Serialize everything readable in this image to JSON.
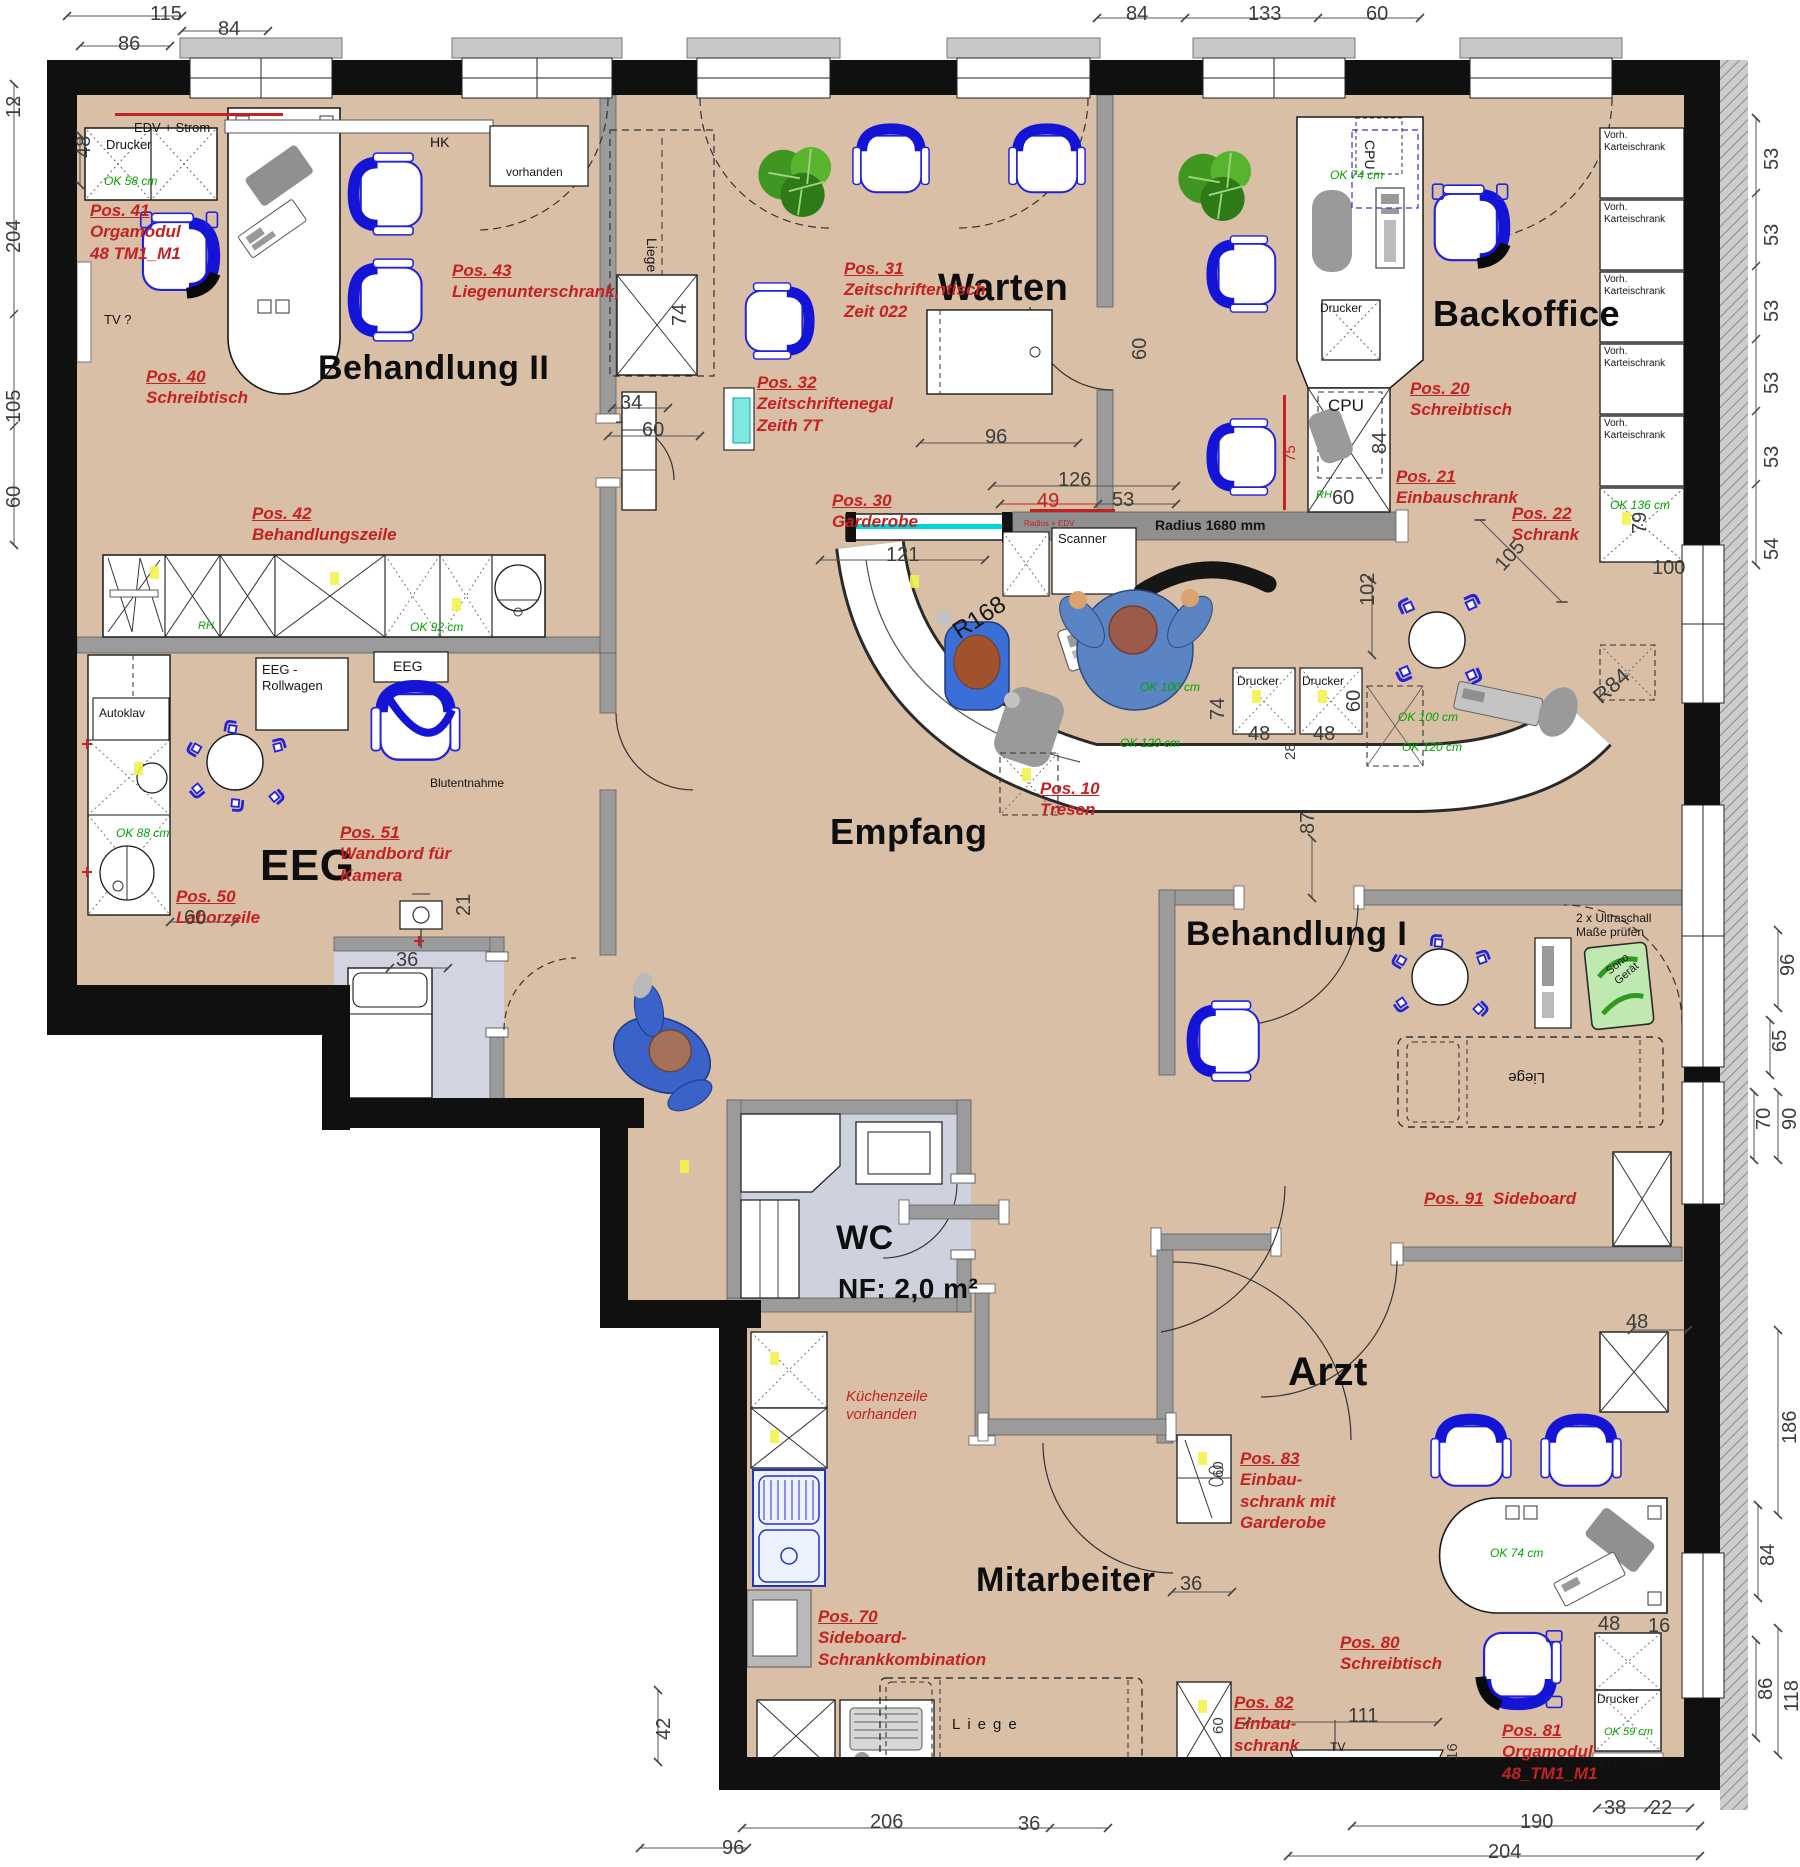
{
  "plan_title": "Praxis Grundriss – Möblierungsplan",
  "colors": {
    "floor": "#d8bfa6",
    "wall": "#101010",
    "inner_wall": "#9b9b9b",
    "pos_red": "#c42222",
    "ok_green": "#00a400",
    "chair_blue": "#1717dd",
    "wet_room": "#ced2de",
    "counter_cyan": "#00d5d5"
  },
  "room_labels": [
    {
      "t": "Behandlung II",
      "x": 318,
      "y": 348,
      "s": 34
    },
    {
      "t": "Warten",
      "x": 938,
      "y": 266,
      "s": 38
    },
    {
      "t": "Backoffice",
      "x": 1433,
      "y": 292,
      "s": 36
    },
    {
      "t": "Empfang",
      "x": 830,
      "y": 810,
      "s": 36
    },
    {
      "t": "EEG",
      "x": 260,
      "y": 840,
      "s": 44
    },
    {
      "t": "Behandlung I",
      "x": 1186,
      "y": 914,
      "s": 34
    },
    {
      "t": "WC",
      "x": 836,
      "y": 1218,
      "s": 34
    },
    {
      "t": "NF: 2,0 m²",
      "x": 838,
      "y": 1272,
      "s": 28
    },
    {
      "t": "Mitarbeiter",
      "x": 976,
      "y": 1560,
      "s": 34
    },
    {
      "t": "Arzt",
      "x": 1288,
      "y": 1348,
      "s": 40
    }
  ],
  "pos_labels": [
    {
      "head": "Pos. 41",
      "rest": [
        "Orgamodul",
        "48 TM1_M1"
      ],
      "x": 90,
      "y": 200
    },
    {
      "head": "Pos. 40",
      "rest": [
        "Schreibtisch"
      ],
      "x": 146,
      "y": 366
    },
    {
      "head": "Pos. 43",
      "rest": [
        "Liegenunterschrank,"
      ],
      "x": 452,
      "y": 260
    },
    {
      "head": "Pos. 42",
      "rest": [
        "Behandlungszeile"
      ],
      "x": 252,
      "y": 503
    },
    {
      "head": "Pos. 31",
      "rest": [
        "Zeitschriftentisch",
        "Zeit 022"
      ],
      "x": 844,
      "y": 258
    },
    {
      "head": "Pos. 32",
      "rest": [
        "Zeitschriftenegal",
        "Zeith 7T"
      ],
      "x": 757,
      "y": 372
    },
    {
      "head": "Pos. 30",
      "rest": [
        "Garderobe"
      ],
      "x": 832,
      "y": 490
    },
    {
      "head": "Pos. 20",
      "rest": [
        "Schreibtisch"
      ],
      "x": 1410,
      "y": 378
    },
    {
      "head": "Pos. 21",
      "rest": [
        "Einbauschrank"
      ],
      "x": 1396,
      "y": 466
    },
    {
      "head": "Pos. 22",
      "rest": [
        "Schrank"
      ],
      "x": 1512,
      "y": 503
    },
    {
      "head": "Pos. 10",
      "rest": [
        "Tresen"
      ],
      "x": 1040,
      "y": 778
    },
    {
      "head": "Pos. 50",
      "rest": [
        "Laborzeile"
      ],
      "x": 176,
      "y": 886
    },
    {
      "head": "Pos. 51",
      "rest": [
        "Wandbord für",
        "Kamera"
      ],
      "x": 340,
      "y": 822
    },
    {
      "head": "Pos. 91",
      "inline": "Sideboard",
      "rest": [],
      "x": 1424,
      "y": 1188
    },
    {
      "head": "Pos. 83",
      "rest": [
        "Einbau-",
        "schrank mit",
        "Garderobe"
      ],
      "x": 1240,
      "y": 1448
    },
    {
      "head": "Pos. 82",
      "rest": [
        "Einbau-",
        "schrank"
      ],
      "x": 1234,
      "y": 1692
    },
    {
      "head": "Pos. 80",
      "rest": [
        "Schreibtisch"
      ],
      "x": 1340,
      "y": 1632
    },
    {
      "head": "Pos. 81",
      "rest": [
        "Orgamodul",
        "48_TM1_M1"
      ],
      "x": 1502,
      "y": 1720
    },
    {
      "head": "Pos. 70",
      "rest": [
        "Sideboard-",
        "Schrankkombination"
      ],
      "x": 818,
      "y": 1606
    }
  ],
  "notes": [
    {
      "lines": [
        "EDV + Strom"
      ],
      "x": 134,
      "y": 120,
      "s": 13
    },
    {
      "lines": [
        "Drucker"
      ],
      "x": 106,
      "y": 137,
      "s": 13
    },
    {
      "lines": [
        "OK 58 cm"
      ],
      "x": 104,
      "y": 174,
      "s": 12,
      "c": "#00a400",
      "i": 1
    },
    {
      "lines": [
        "TV ?"
      ],
      "x": 104,
      "y": 312,
      "s": 13
    },
    {
      "lines": [
        "HK"
      ],
      "x": 430,
      "y": 134,
      "s": 14
    },
    {
      "lines": [
        "vorhanden"
      ],
      "x": 506,
      "y": 165,
      "s": 12
    },
    {
      "lines": [
        "Liege"
      ],
      "x": 660,
      "y": 238,
      "s": 14,
      "rot": 90
    },
    {
      "lines": [
        "Scanner"
      ],
      "x": 1058,
      "y": 531,
      "s": 13
    },
    {
      "lines": [
        "Radius 1680 mm"
      ],
      "x": 1155,
      "y": 517,
      "s": 14,
      "b": 1
    },
    {
      "lines": [
        "Radius + EDV"
      ],
      "x": 1024,
      "y": 519,
      "s": 8,
      "c": "#c42222"
    },
    {
      "lines": [
        "R168"
      ],
      "x": 948,
      "y": 622,
      "s": 24,
      "rot": -33
    },
    {
      "lines": [
        "OK 100 cm"
      ],
      "x": 1140,
      "y": 680,
      "s": 12,
      "c": "#00a400",
      "i": 1
    },
    {
      "lines": [
        "OK 120 cm"
      ],
      "x": 1120,
      "y": 736,
      "s": 12,
      "c": "#00a400",
      "i": 1
    },
    {
      "lines": [
        "OK 100 cm"
      ],
      "x": 1398,
      "y": 710,
      "s": 12,
      "c": "#00a400",
      "i": 1
    },
    {
      "lines": [
        "OK 120 cm"
      ],
      "x": 1402,
      "y": 740,
      "s": 12,
      "c": "#00a400",
      "i": 1
    },
    {
      "lines": [
        "Drucker"
      ],
      "x": 1237,
      "y": 674,
      "s": 12
    },
    {
      "lines": [
        "Drucker"
      ],
      "x": 1302,
      "y": 674,
      "s": 12
    },
    {
      "lines": [
        "OK 74 cm"
      ],
      "x": 1330,
      "y": 168,
      "s": 12,
      "c": "#00a400",
      "i": 1
    },
    {
      "lines": [
        "Drucker"
      ],
      "x": 1320,
      "y": 301,
      "s": 12
    },
    {
      "lines": [
        "CPU"
      ],
      "x": 1328,
      "y": 396,
      "s": 17
    },
    {
      "lines": [
        "CPU"
      ],
      "x": 1378,
      "y": 140,
      "s": 14,
      "rot": 90
    },
    {
      "lines": [
        "Vorh.",
        "Karteischrank"
      ],
      "x": 1604,
      "y": 130,
      "s": 10
    },
    {
      "lines": [
        "Vorh.",
        "Karteischrank"
      ],
      "x": 1604,
      "y": 202,
      "s": 10
    },
    {
      "lines": [
        "Vorh.",
        "Karteischrank"
      ],
      "x": 1604,
      "y": 274,
      "s": 10
    },
    {
      "lines": [
        "Vorh.",
        "Karteischrank"
      ],
      "x": 1604,
      "y": 346,
      "s": 10
    },
    {
      "lines": [
        "Vorh.",
        "Karteischrank"
      ],
      "x": 1604,
      "y": 418,
      "s": 10
    },
    {
      "lines": [
        "OK 136 cm"
      ],
      "x": 1610,
      "y": 498,
      "s": 12,
      "c": "#00a400",
      "i": 1
    },
    {
      "lines": [
        "EEG -",
        "Rollwagen"
      ],
      "x": 262,
      "y": 662,
      "s": 13
    },
    {
      "lines": [
        "EEG"
      ],
      "x": 393,
      "y": 658,
      "s": 14
    },
    {
      "lines": [
        "Autoklav"
      ],
      "x": 99,
      "y": 706,
      "s": 12
    },
    {
      "lines": [
        "Blutentnahme"
      ],
      "x": 430,
      "y": 776,
      "s": 12
    },
    {
      "lines": [
        "OK 92 cm"
      ],
      "x": 410,
      "y": 620,
      "s": 12,
      "c": "#00a400",
      "i": 1
    },
    {
      "lines": [
        "RH"
      ],
      "x": 198,
      "y": 620,
      "s": 11,
      "c": "#00a400",
      "i": 1
    },
    {
      "lines": [
        "RH"
      ],
      "x": 1316,
      "y": 489,
      "s": 11,
      "c": "#00a400",
      "i": 1
    },
    {
      "lines": [
        "OK 88 cm"
      ],
      "x": 116,
      "y": 826,
      "s": 12,
      "c": "#00a400",
      "i": 1
    },
    {
      "lines": [
        "2 x Ultraschall",
        "Maße prüfen"
      ],
      "x": 1576,
      "y": 911,
      "s": 12
    },
    {
      "lines": [
        "Sono",
        "Gerät"
      ],
      "x": 1604,
      "y": 968,
      "s": 11,
      "rot": -40
    },
    {
      "lines": [
        "Liege"
      ],
      "x": 1545,
      "y": 1086,
      "s": 15,
      "rot": 180
    },
    {
      "lines": [
        "Liege"
      ],
      "x": 952,
      "y": 1716,
      "s": 15,
      "ls": 7
    },
    {
      "lines": [
        "TV"
      ],
      "x": 1330,
      "y": 1740,
      "s": 12
    },
    {
      "lines": [
        "Drucker"
      ],
      "x": 1597,
      "y": 1692,
      "s": 12
    },
    {
      "lines": [
        "OK 59 cm"
      ],
      "x": 1604,
      "y": 1726,
      "s": 11,
      "c": "#00a400",
      "i": 1
    },
    {
      "lines": [
        "EDV + Strom"
      ],
      "x": 1599,
      "y": 1756,
      "s": 12
    },
    {
      "lines": [
        "OK 74 cm"
      ],
      "x": 1490,
      "y": 1546,
      "s": 12,
      "c": "#00a400",
      "i": 1
    },
    {
      "lines": [
        "Küchenzeile",
        "vorhanden"
      ],
      "x": 846,
      "y": 1388,
      "s": 15,
      "c": "#c42222",
      "i": 1
    }
  ],
  "dims": [
    {
      "t": "115",
      "x": 150,
      "y": 2
    },
    {
      "t": "86",
      "x": 118,
      "y": 32
    },
    {
      "t": "84",
      "x": 218,
      "y": 17
    },
    {
      "t": "84",
      "x": 1126,
      "y": 2
    },
    {
      "t": "133",
      "x": 1248,
      "y": 2
    },
    {
      "t": "60",
      "x": 1366,
      "y": 2
    },
    {
      "t": "12",
      "x": 2,
      "y": 118,
      "rot": -90
    },
    {
      "t": "204",
      "x": 2,
      "y": 253,
      "rot": -90
    },
    {
      "t": "105",
      "x": 2,
      "y": 423,
      "rot": -90
    },
    {
      "t": "60",
      "x": 2,
      "y": 508,
      "rot": -90
    },
    {
      "t": "48",
      "x": 72,
      "y": 158,
      "rot": -90
    },
    {
      "t": "53",
      "x": 1760,
      "y": 170,
      "rot": -90
    },
    {
      "t": "53",
      "x": 1760,
      "y": 246,
      "rot": -90
    },
    {
      "t": "53",
      "x": 1760,
      "y": 322,
      "rot": -90
    },
    {
      "t": "53",
      "x": 1760,
      "y": 394,
      "rot": -90
    },
    {
      "t": "53",
      "x": 1760,
      "y": 468,
      "rot": -90
    },
    {
      "t": "54",
      "x": 1760,
      "y": 560,
      "rot": -90
    },
    {
      "t": "79",
      "x": 1628,
      "y": 534,
      "rot": -90
    },
    {
      "t": "100",
      "x": 1652,
      "y": 556
    },
    {
      "t": "96",
      "x": 1776,
      "y": 976,
      "rot": -90
    },
    {
      "t": "65",
      "x": 1768,
      "y": 1052,
      "rot": -90
    },
    {
      "t": "90",
      "x": 1778,
      "y": 1130,
      "rot": -90
    },
    {
      "t": "70",
      "x": 1752,
      "y": 1130,
      "rot": -90
    },
    {
      "t": "186",
      "x": 1778,
      "y": 1444,
      "rot": -90
    },
    {
      "t": "84",
      "x": 1756,
      "y": 1566,
      "rot": -90
    },
    {
      "t": "118",
      "x": 1780,
      "y": 1712,
      "rot": -90
    },
    {
      "t": "86",
      "x": 1754,
      "y": 1700,
      "rot": -90
    },
    {
      "t": "42",
      "x": 652,
      "y": 1740,
      "rot": -90
    },
    {
      "t": "96",
      "x": 722,
      "y": 1836
    },
    {
      "t": "206",
      "x": 870,
      "y": 1810
    },
    {
      "t": "36",
      "x": 1018,
      "y": 1812
    },
    {
      "t": "190",
      "x": 1520,
      "y": 1810
    },
    {
      "t": "204",
      "x": 1488,
      "y": 1840
    },
    {
      "t": "38",
      "x": 1604,
      "y": 1796
    },
    {
      "t": "22",
      "x": 1650,
      "y": 1796
    },
    {
      "t": "34",
      "x": 620,
      "y": 391
    },
    {
      "t": "60",
      "x": 642,
      "y": 418
    },
    {
      "t": "74",
      "x": 668,
      "y": 326,
      "rot": -90
    },
    {
      "t": "96",
      "x": 985,
      "y": 425
    },
    {
      "t": "126",
      "x": 1058,
      "y": 468
    },
    {
      "t": "49",
      "x": 1037,
      "y": 489,
      "c": "#c42222"
    },
    {
      "t": "53",
      "x": 1112,
      "y": 488
    },
    {
      "t": "121",
      "x": 886,
      "y": 543
    },
    {
      "t": "60",
      "x": 1128,
      "y": 360,
      "rot": -90
    },
    {
      "t": "84",
      "x": 1368,
      "y": 454,
      "rot": -90
    },
    {
      "t": "60",
      "x": 1332,
      "y": 486
    },
    {
      "t": "75",
      "x": 1282,
      "y": 462,
      "rot": -90,
      "c": "#c42222",
      "s": 15
    },
    {
      "t": "102",
      "x": 1356,
      "y": 606,
      "rot": -90
    },
    {
      "t": "105",
      "x": 1490,
      "y": 560,
      "rot": -48
    },
    {
      "t": "R84",
      "x": 1588,
      "y": 690,
      "rot": -42,
      "s": 22
    },
    {
      "t": "74",
      "x": 1206,
      "y": 720,
      "rot": -90
    },
    {
      "t": "48",
      "x": 1248,
      "y": 722
    },
    {
      "t": "48",
      "x": 1313,
      "y": 722
    },
    {
      "t": "28",
      "x": 1282,
      "y": 760,
      "rot": -90,
      "s": 15
    },
    {
      "t": "60",
      "x": 1342,
      "y": 712,
      "rot": -90
    },
    {
      "t": "87",
      "x": 1296,
      "y": 834,
      "rot": -90
    },
    {
      "t": "60",
      "x": 184,
      "y": 906
    },
    {
      "t": "36",
      "x": 396,
      "y": 948
    },
    {
      "t": "21",
      "x": 452,
      "y": 916,
      "rot": -90
    },
    {
      "t": "36",
      "x": 1180,
      "y": 1572
    },
    {
      "t": "48",
      "x": 1626,
      "y": 1310
    },
    {
      "t": "48",
      "x": 1598,
      "y": 1612
    },
    {
      "t": "16",
      "x": 1648,
      "y": 1614
    },
    {
      "t": "111",
      "x": 1348,
      "y": 1704
    },
    {
      "t": "16",
      "x": 1444,
      "y": 1760,
      "rot": -90,
      "s": 15
    },
    {
      "t": "60",
      "x": 1210,
      "y": 1734,
      "rot": -90,
      "s": 15
    },
    {
      "t": "60",
      "x": 1210,
      "y": 1478,
      "rot": -90,
      "s": 15
    }
  ]
}
